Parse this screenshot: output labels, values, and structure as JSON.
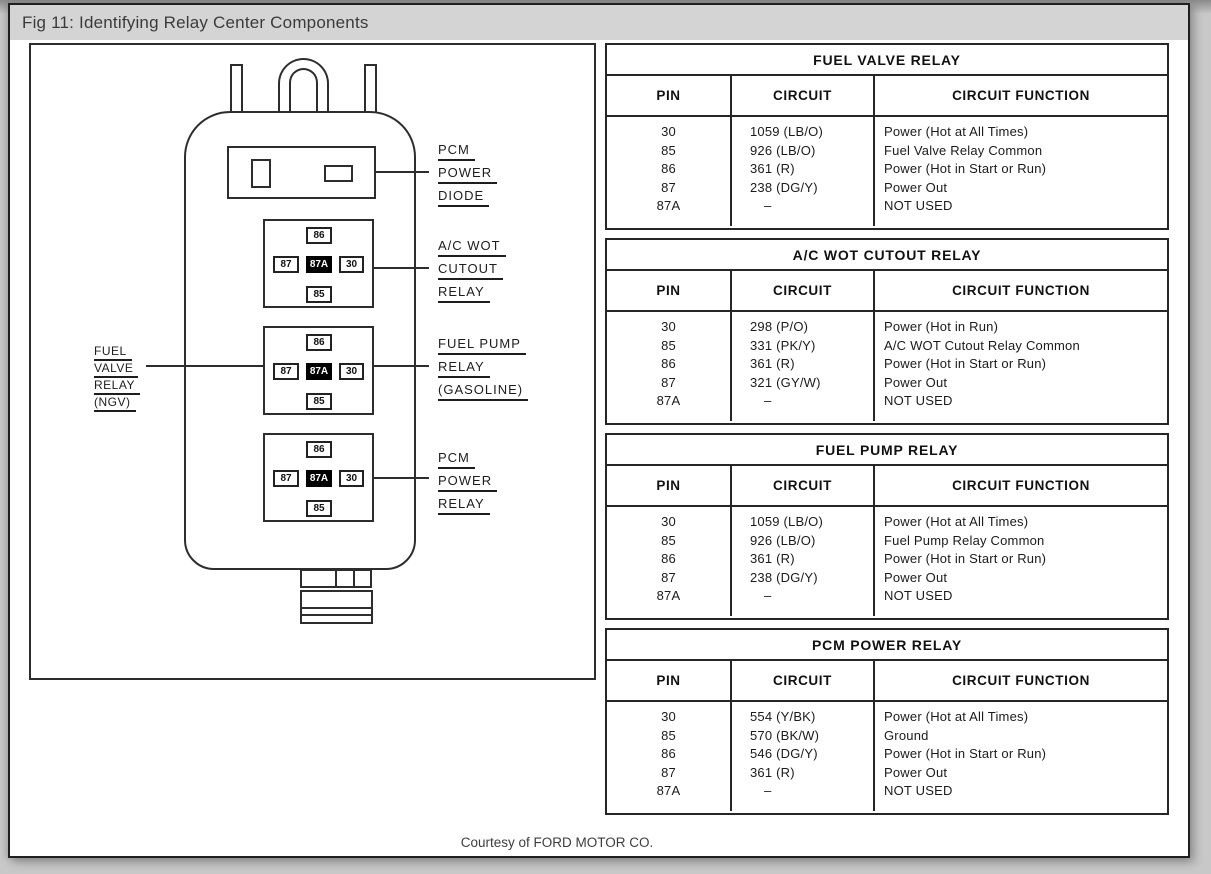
{
  "window": {
    "title": "Fig 11: Identifying Relay Center Components",
    "courtesy": "Courtesy of FORD MOTOR CO."
  },
  "diagram": {
    "pins": {
      "top": "86",
      "left": "87",
      "center": "87A",
      "right": "30",
      "bottom": "85"
    },
    "side_labels": {
      "pcm_power_diode": {
        "lines": [
          "PCM",
          "POWER",
          "DIODE"
        ]
      },
      "ac_wot_cutout_relay": {
        "lines": [
          "A/C WOT",
          "CUTOUT",
          "RELAY"
        ]
      },
      "fuel_pump_relay": {
        "lines": [
          "FUEL PUMP",
          "RELAY",
          "(GASOLINE)"
        ]
      },
      "pcm_power_relay": {
        "lines": [
          "PCM",
          "POWER",
          "RELAY"
        ]
      },
      "fuel_valve_relay": {
        "lines": [
          "FUEL",
          "VALVE",
          "RELAY",
          "(NGV)"
        ]
      }
    }
  },
  "tables": [
    {
      "title": "FUEL VALVE RELAY",
      "columns": [
        "PIN",
        "CIRCUIT",
        "CIRCUIT FUNCTION"
      ],
      "rows": [
        [
          "30",
          "1059 (LB/O)",
          "Power (Hot at All Times)"
        ],
        [
          "85",
          "926 (LB/O)",
          "Fuel Valve Relay Common"
        ],
        [
          "86",
          "361 (R)",
          "Power (Hot in Start or Run)"
        ],
        [
          "87",
          "238 (DG/Y)",
          "Power Out"
        ],
        [
          "87A",
          "–",
          "NOT USED"
        ]
      ]
    },
    {
      "title": "A/C WOT CUTOUT RELAY",
      "columns": [
        "PIN",
        "CIRCUIT",
        "CIRCUIT FUNCTION"
      ],
      "rows": [
        [
          "30",
          "298 (P/O)",
          "Power (Hot in Run)"
        ],
        [
          "85",
          "331 (PK/Y)",
          "A/C WOT Cutout Relay Common"
        ],
        [
          "86",
          "361 (R)",
          "Power (Hot in Start or Run)"
        ],
        [
          "87",
          "321 (GY/W)",
          "Power Out"
        ],
        [
          "87A",
          "–",
          "NOT USED"
        ]
      ]
    },
    {
      "title": "FUEL PUMP RELAY",
      "columns": [
        "PIN",
        "CIRCUIT",
        "CIRCUIT FUNCTION"
      ],
      "rows": [
        [
          "30",
          "1059 (LB/O)",
          "Power (Hot at All Times)"
        ],
        [
          "85",
          "926 (LB/O)",
          "Fuel Pump Relay Common"
        ],
        [
          "86",
          "361 (R)",
          "Power (Hot in Start or Run)"
        ],
        [
          "87",
          "238 (DG/Y)",
          "Power Out"
        ],
        [
          "87A",
          "–",
          "NOT USED"
        ]
      ]
    },
    {
      "title": "PCM POWER RELAY",
      "columns": [
        "PIN",
        "CIRCUIT",
        "CIRCUIT FUNCTION"
      ],
      "rows": [
        [
          "30",
          "554 (Y/BK)",
          "Power (Hot at All Times)"
        ],
        [
          "85",
          "570 (BK/W)",
          "Ground"
        ],
        [
          "86",
          "546 (DG/Y)",
          "Power (Hot in Start or Run)"
        ],
        [
          "87",
          "361 (R)",
          "Power Out"
        ],
        [
          "87A",
          "–",
          "NOT USED"
        ]
      ]
    }
  ]
}
